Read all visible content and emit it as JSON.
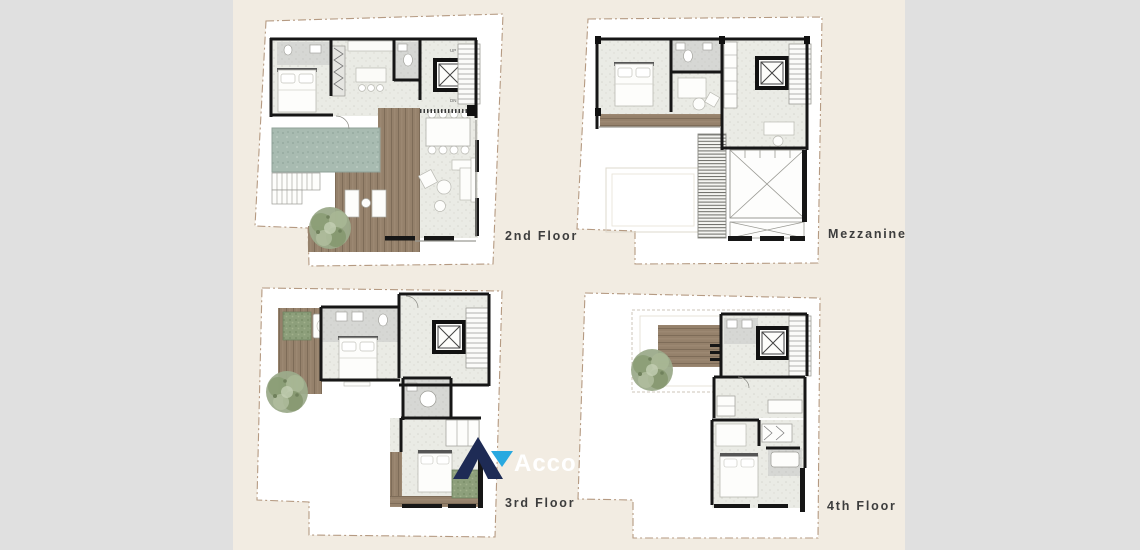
{
  "colors": {
    "canvas_background": "#f2ece2",
    "side_strip": "#e0e0e0",
    "lot_outline_dash": "#b59a82",
    "wall": "#161616",
    "wood_deck": "#95816b",
    "pool": "#a8bbb1",
    "tree_foliage": "#9cab8b",
    "bathroom_floor": "#d6d7d4",
    "watermark_navy": "#1e2b55",
    "watermark_blue": "#29a9e0",
    "label_text": "#3d3d3d"
  },
  "floor_plans": [
    {
      "id": "second-floor",
      "label": "2nd Floor",
      "stair_up": "UP",
      "stair_dn": "DN"
    },
    {
      "id": "mezzanine",
      "label": "Mezzanine"
    },
    {
      "id": "third-floor",
      "label": "3rd Floor"
    },
    {
      "id": "fourth-floor",
      "label": "4th Floor"
    }
  ],
  "watermark": {
    "text": "Acco"
  }
}
